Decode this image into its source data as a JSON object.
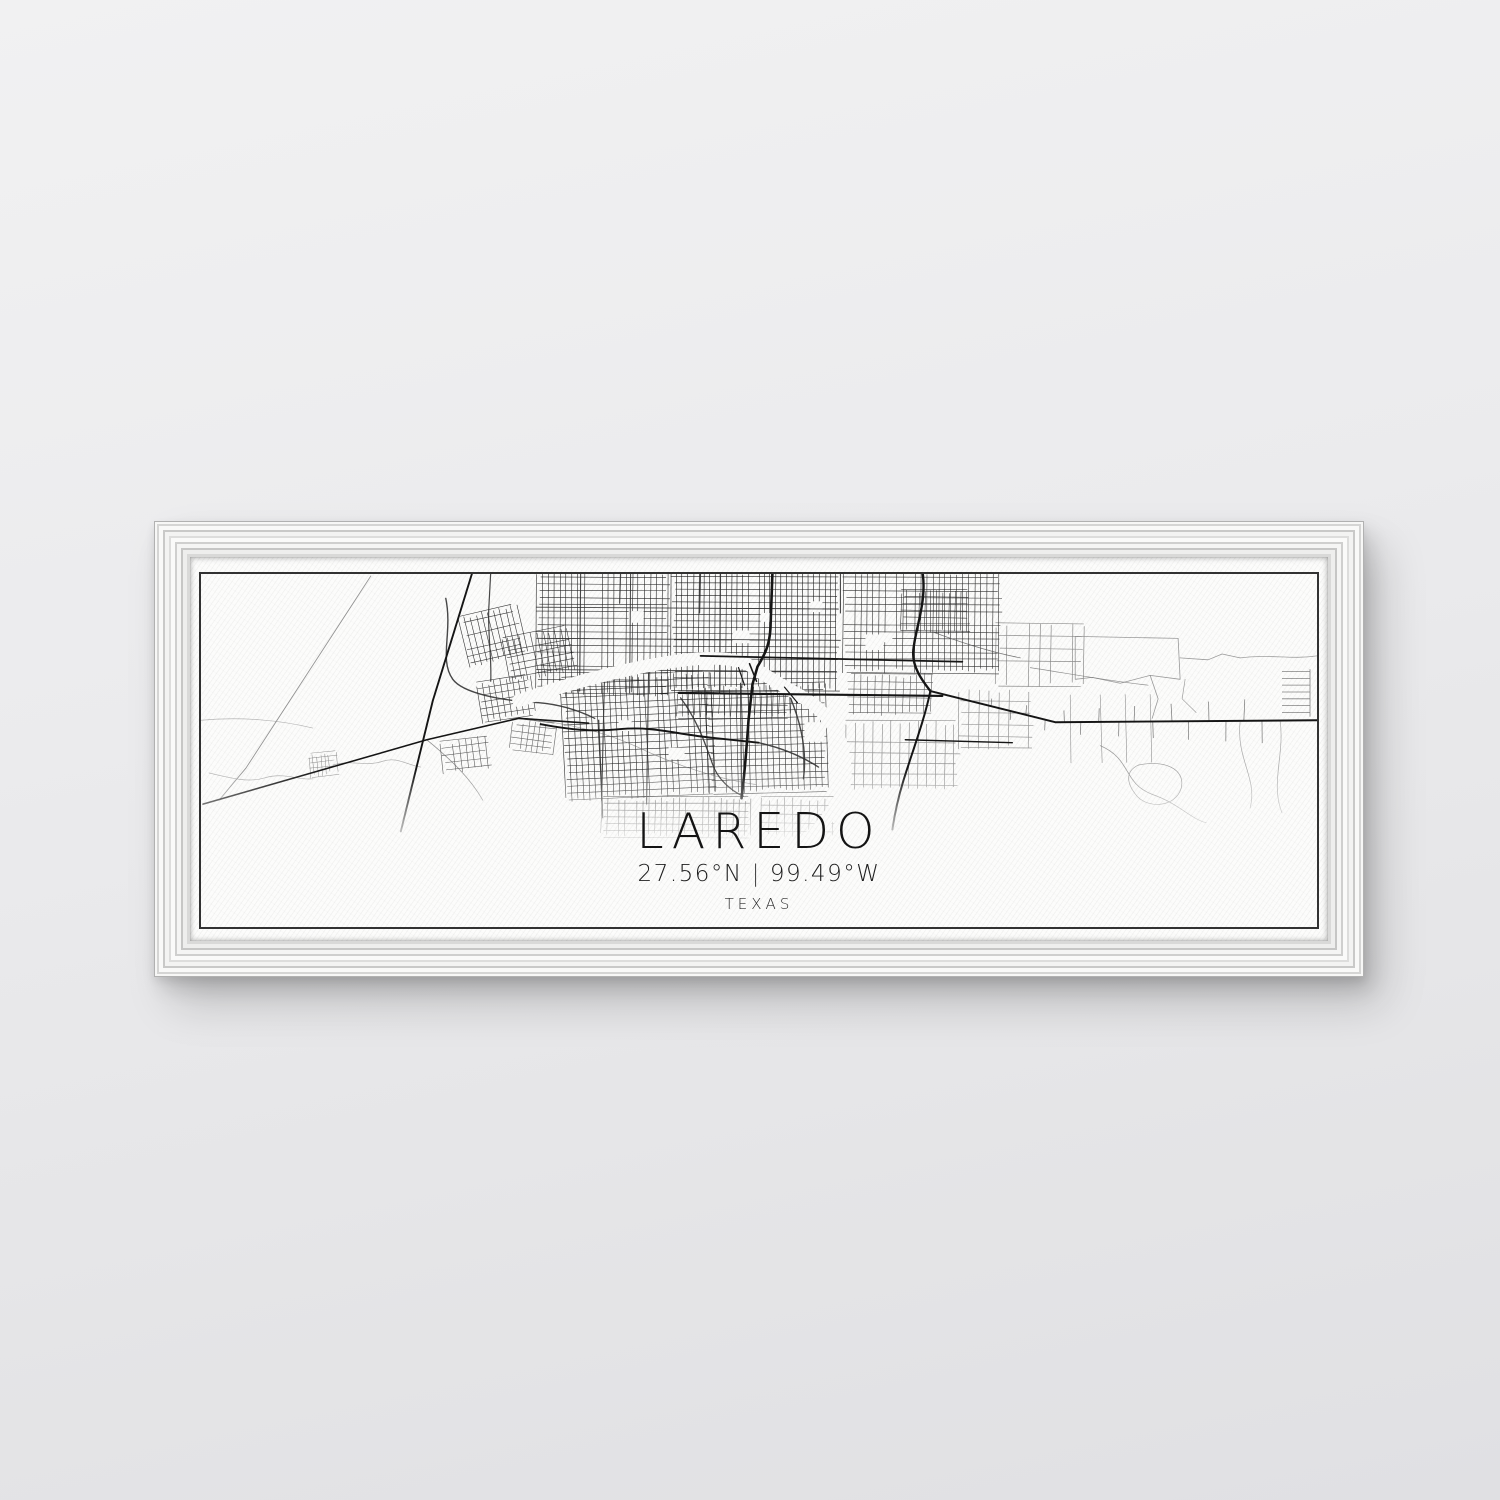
{
  "artwork": {
    "title": "LAREDO",
    "latitude": "27.56°N",
    "separator": "|",
    "longitude": "99.49°W",
    "region": "TEXAS"
  },
  "colors": {
    "wall": "#e9e9eb",
    "frame": "#ededec",
    "canvas": "#fcfcfb",
    "ink": "#141414",
    "map_border": "#323232"
  }
}
